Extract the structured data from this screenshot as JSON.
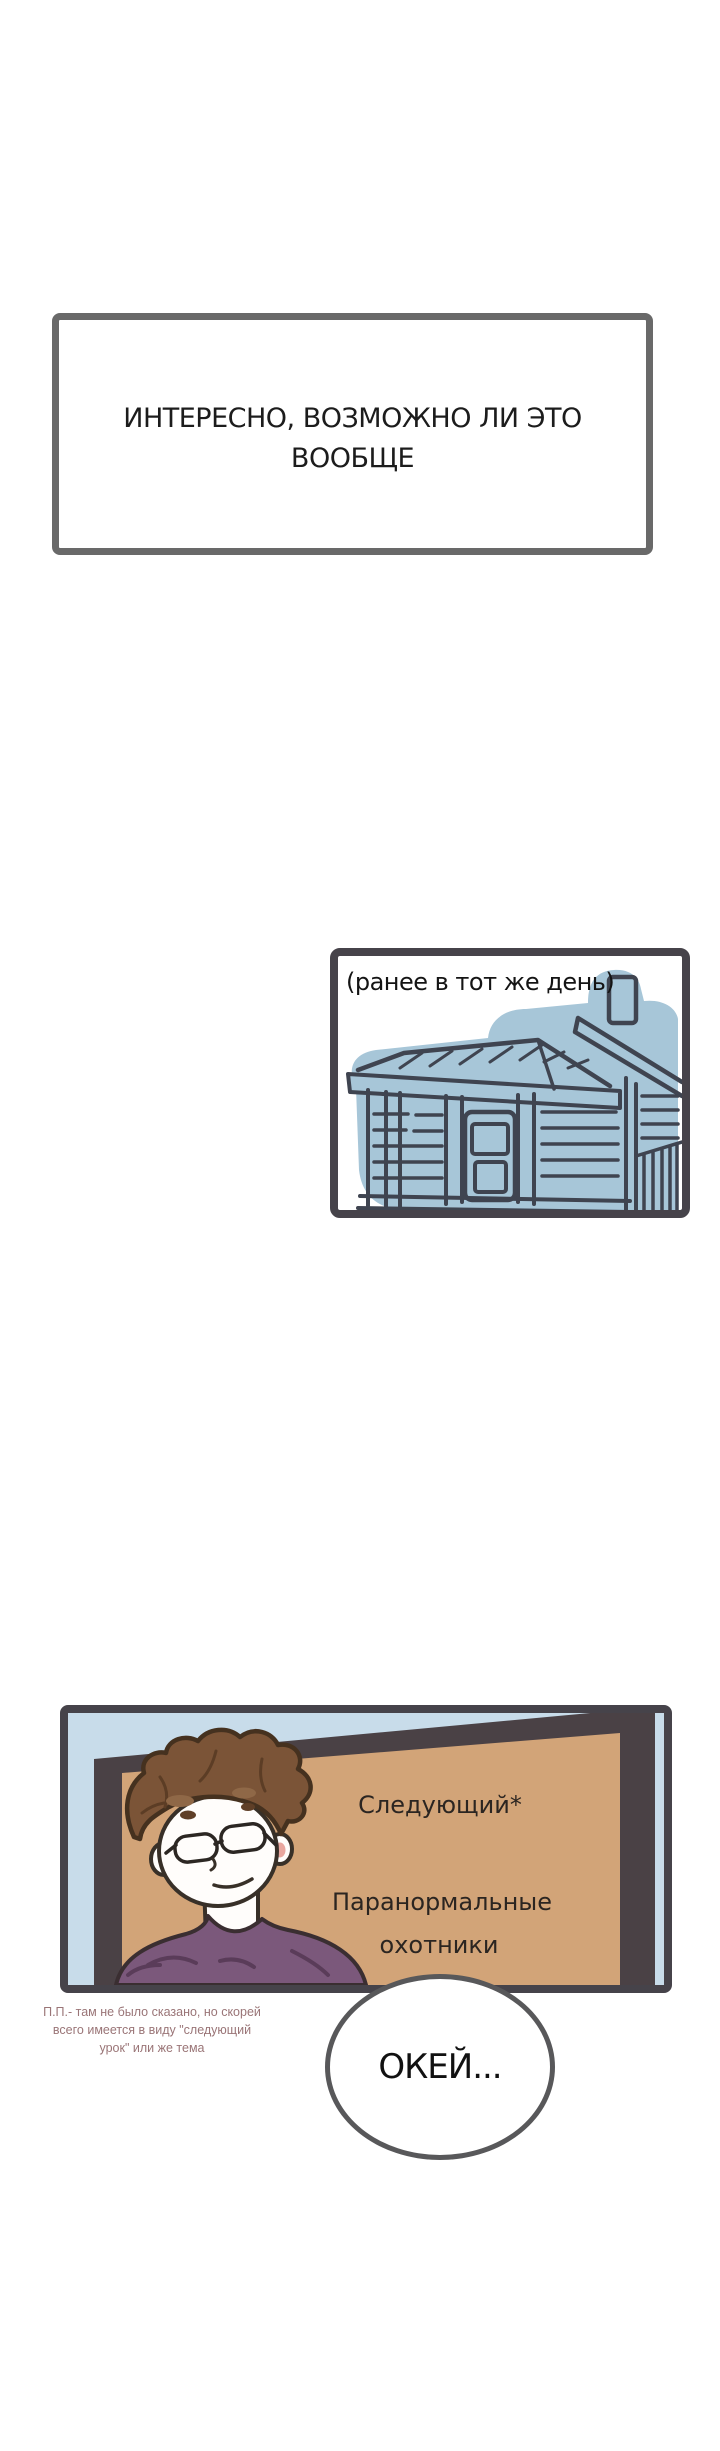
{
  "page": {
    "width_px": 720,
    "height_px": 2451,
    "background": "#ffffff"
  },
  "panel_thought": {
    "line1": "ИНТЕРЕСНО, ВОЗМОЖНО ЛИ ЭТО",
    "line2": "ВООБЩЕ"
  },
  "panel_flashback": {
    "caption": "(ранее в тот же день)"
  },
  "panel_tv": {
    "board_line1": "Следующий*",
    "board_line2": "Паранормальные",
    "board_line3": "охотники"
  },
  "translator_note": {
    "line1": "П.П.- там не было сказано, но скорей",
    "line2": "всего имеется в виду \"следующий",
    "line3": "урок\" или же тема"
  },
  "speech_bubble": {
    "text": "ОКЕЙ..."
  },
  "colors": {
    "panel1_border": "#696969",
    "panel_border": "#46434a",
    "house_fill": "#a7c6d8",
    "line_art": "#3f4450",
    "sky_blue": "#c8dcea",
    "board_face": "#d2a478",
    "board_frame": "#4a4145",
    "hair_brown": "#7b5437",
    "shirt_purple": "#7b587b",
    "skin": "#fffdfb",
    "blush_pink": "#e9a79f",
    "note_text": "#9a7577",
    "bubble_border": "#58585a",
    "text_dark": "#1c1c1c"
  }
}
